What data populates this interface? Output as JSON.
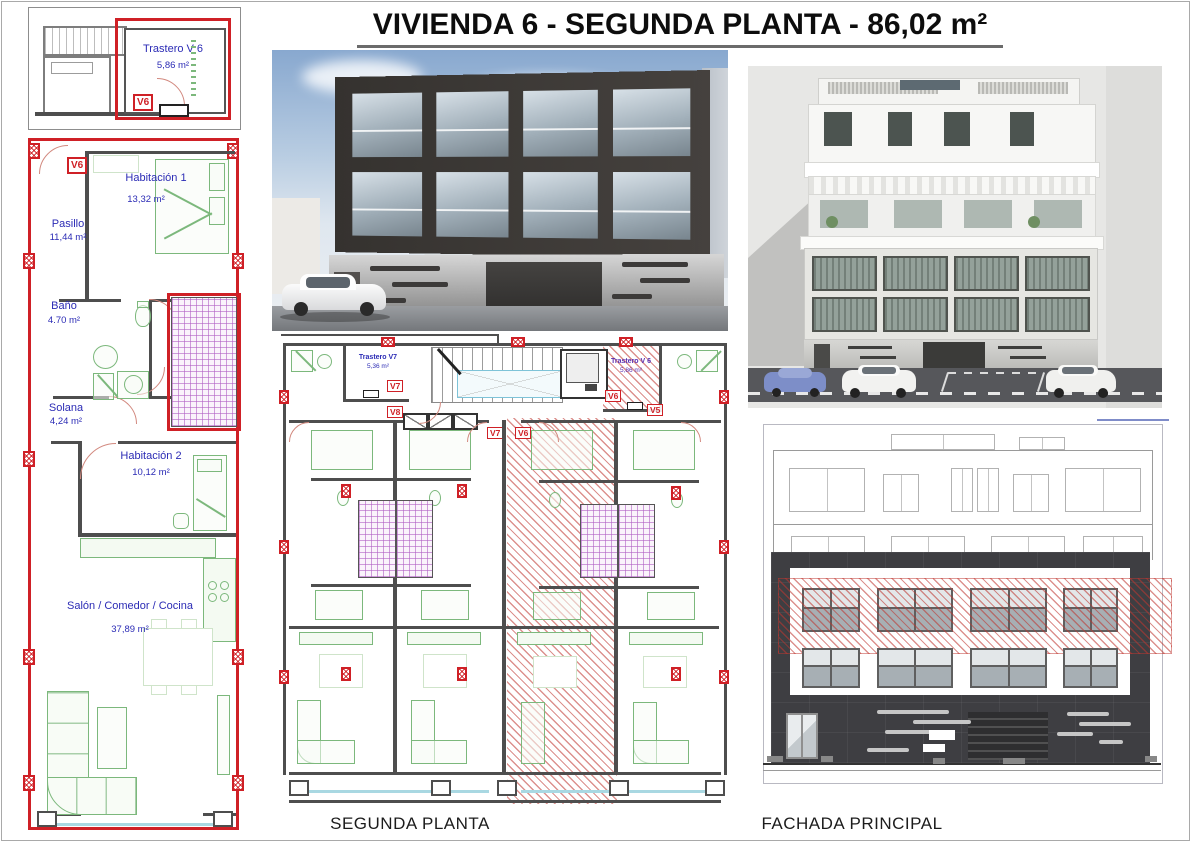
{
  "title": "VIVIENDA 6 - SEGUNDA PLANTA - 86,02 m²",
  "storage_inset": {
    "name": "Trastero V 6",
    "area": "5,86 m²",
    "tag": "V6"
  },
  "apartment": {
    "tag": "V6",
    "rooms": [
      {
        "name": "Habitación 1",
        "area": "13,32 m²"
      },
      {
        "name": "Pasillo",
        "area": "11,44 m²"
      },
      {
        "name": "Baño",
        "area": "4.70 m²"
      },
      {
        "name": "Solana",
        "area": "4,24 m²"
      },
      {
        "name": "Habitación 2",
        "area": "10,12 m²"
      },
      {
        "name": "Salón / Comedor / Cocina",
        "area": "37,89 m²"
      }
    ]
  },
  "floor_plan": {
    "caption": "SEGUNDA PLANTA",
    "storage_left": {
      "name": "Trastero V7",
      "area": "5,36 m²",
      "tag": "V7"
    },
    "storage_right": {
      "name": "Trastero V 6",
      "area": "5,86 m²",
      "tag": "V6"
    },
    "tags": {
      "unit_left": "V8",
      "door_left": "V7",
      "door_right": "V6",
      "unit_right": "V5"
    }
  },
  "elevation": {
    "caption": "FACHADA PRINCIPAL"
  },
  "colors": {
    "highlight_red": "#cf2026",
    "label_blue": "#2b2bb5",
    "furniture_green": "#7cb87c",
    "patio_purple": "#b05fc4",
    "facade_dark": "#3e3e42"
  }
}
